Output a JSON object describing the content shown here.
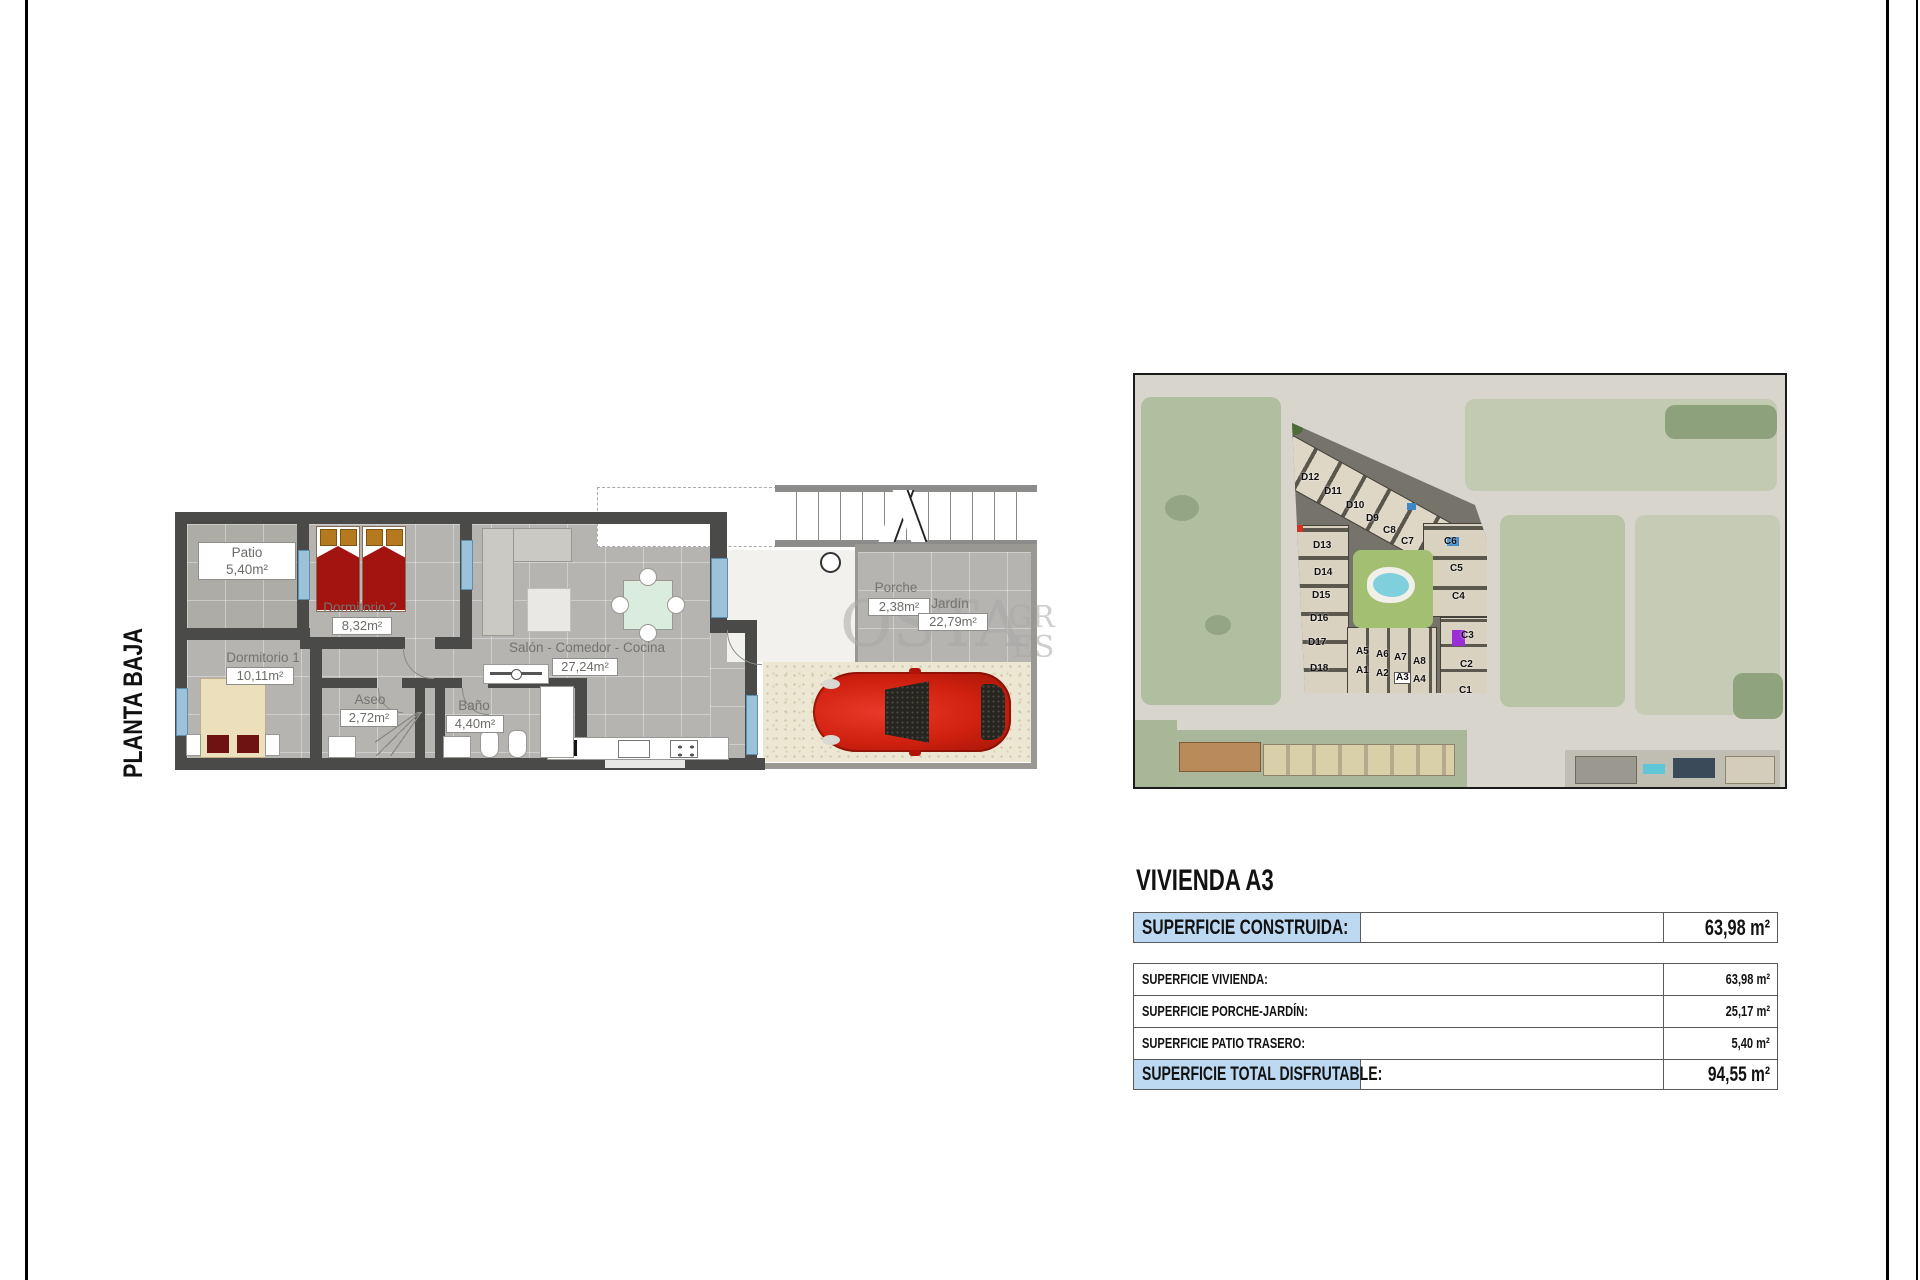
{
  "page": {
    "floor_label": "PLANTA BAJA",
    "watermark": {
      "big": "OSTA",
      "small_top": "GR",
      "small_bottom": "ES"
    }
  },
  "floor_plan": {
    "rooms": {
      "patio": {
        "name": "Patio",
        "area": "5,40m²"
      },
      "dorm2": {
        "name": "Dormitorio 2",
        "area": "8,32m²"
      },
      "dorm1": {
        "name": "Dormitorio 1",
        "area": "10,11m²"
      },
      "aseo": {
        "name": "Aseo",
        "area": "2,72m²"
      },
      "bano": {
        "name": "Baño",
        "area": "4,40m²"
      },
      "salon": {
        "name": "Salón - Comedor - Cocina",
        "area": "27,24m²"
      },
      "porche": {
        "name": "Porche",
        "area": "2,38m²"
      },
      "jardin": {
        "name": "Jardín",
        "area": "22,79m²"
      }
    }
  },
  "site_map": {
    "unit_labels": [
      {
        "t": "D12",
        "x": 166,
        "y": 98
      },
      {
        "t": "D11",
        "x": 189,
        "y": 112
      },
      {
        "t": "D10",
        "x": 211,
        "y": 126
      },
      {
        "t": "D9",
        "x": 231,
        "y": 139
      },
      {
        "t": "C8",
        "x": 248,
        "y": 151
      },
      {
        "t": "C7",
        "x": 266,
        "y": 162
      },
      {
        "t": "C6",
        "x": 309,
        "y": 162
      },
      {
        "t": "C5",
        "x": 315,
        "y": 189
      },
      {
        "t": "C4",
        "x": 317,
        "y": 217
      },
      {
        "t": "D13",
        "x": 178,
        "y": 166
      },
      {
        "t": "D14",
        "x": 179,
        "y": 193
      },
      {
        "t": "D15",
        "x": 177,
        "y": 216
      },
      {
        "t": "D16",
        "x": 175,
        "y": 239
      },
      {
        "t": "D17",
        "x": 173,
        "y": 263
      },
      {
        "t": "D18",
        "x": 175,
        "y": 289
      },
      {
        "t": "A5",
        "x": 221,
        "y": 272
      },
      {
        "t": "A6",
        "x": 241,
        "y": 275
      },
      {
        "t": "A7",
        "x": 259,
        "y": 278
      },
      {
        "t": "A8",
        "x": 278,
        "y": 282
      },
      {
        "t": "A1",
        "x": 221,
        "y": 291
      },
      {
        "t": "A2",
        "x": 241,
        "y": 294
      },
      {
        "t": "A3",
        "x": 259,
        "y": 297,
        "hl": true
      },
      {
        "t": "A4",
        "x": 278,
        "y": 300
      },
      {
        "t": "C3",
        "x": 326,
        "y": 256
      },
      {
        "t": "C2",
        "x": 325,
        "y": 285
      },
      {
        "t": "C1",
        "x": 324,
        "y": 311
      }
    ]
  },
  "summary": {
    "title": "VIVIENDA A3",
    "header": {
      "label": "SUPERFICIE CONSTRUIDA:",
      "value": "63,98 m²"
    },
    "rows": [
      {
        "label": "SUPERFICIE VIVIENDA:",
        "value": "63,98 m²"
      },
      {
        "label": "SUPERFICIE PORCHE-JARDÍN:",
        "value": "25,17 m²"
      },
      {
        "label": "SUPERFICIE PATIO TRASERO:",
        "value": "5,40 m²"
      }
    ],
    "total": {
      "label": "SUPERFICIE TOTAL DISFRUTABLE:",
      "value": "94,55 m²"
    }
  },
  "colors": {
    "table_highlight": "#bdd9f2",
    "plan_wall": "#4a4a48",
    "bed_red": "#a31310",
    "car_red": "#d0200f",
    "pool_cyan": "#7fd0dc"
  }
}
